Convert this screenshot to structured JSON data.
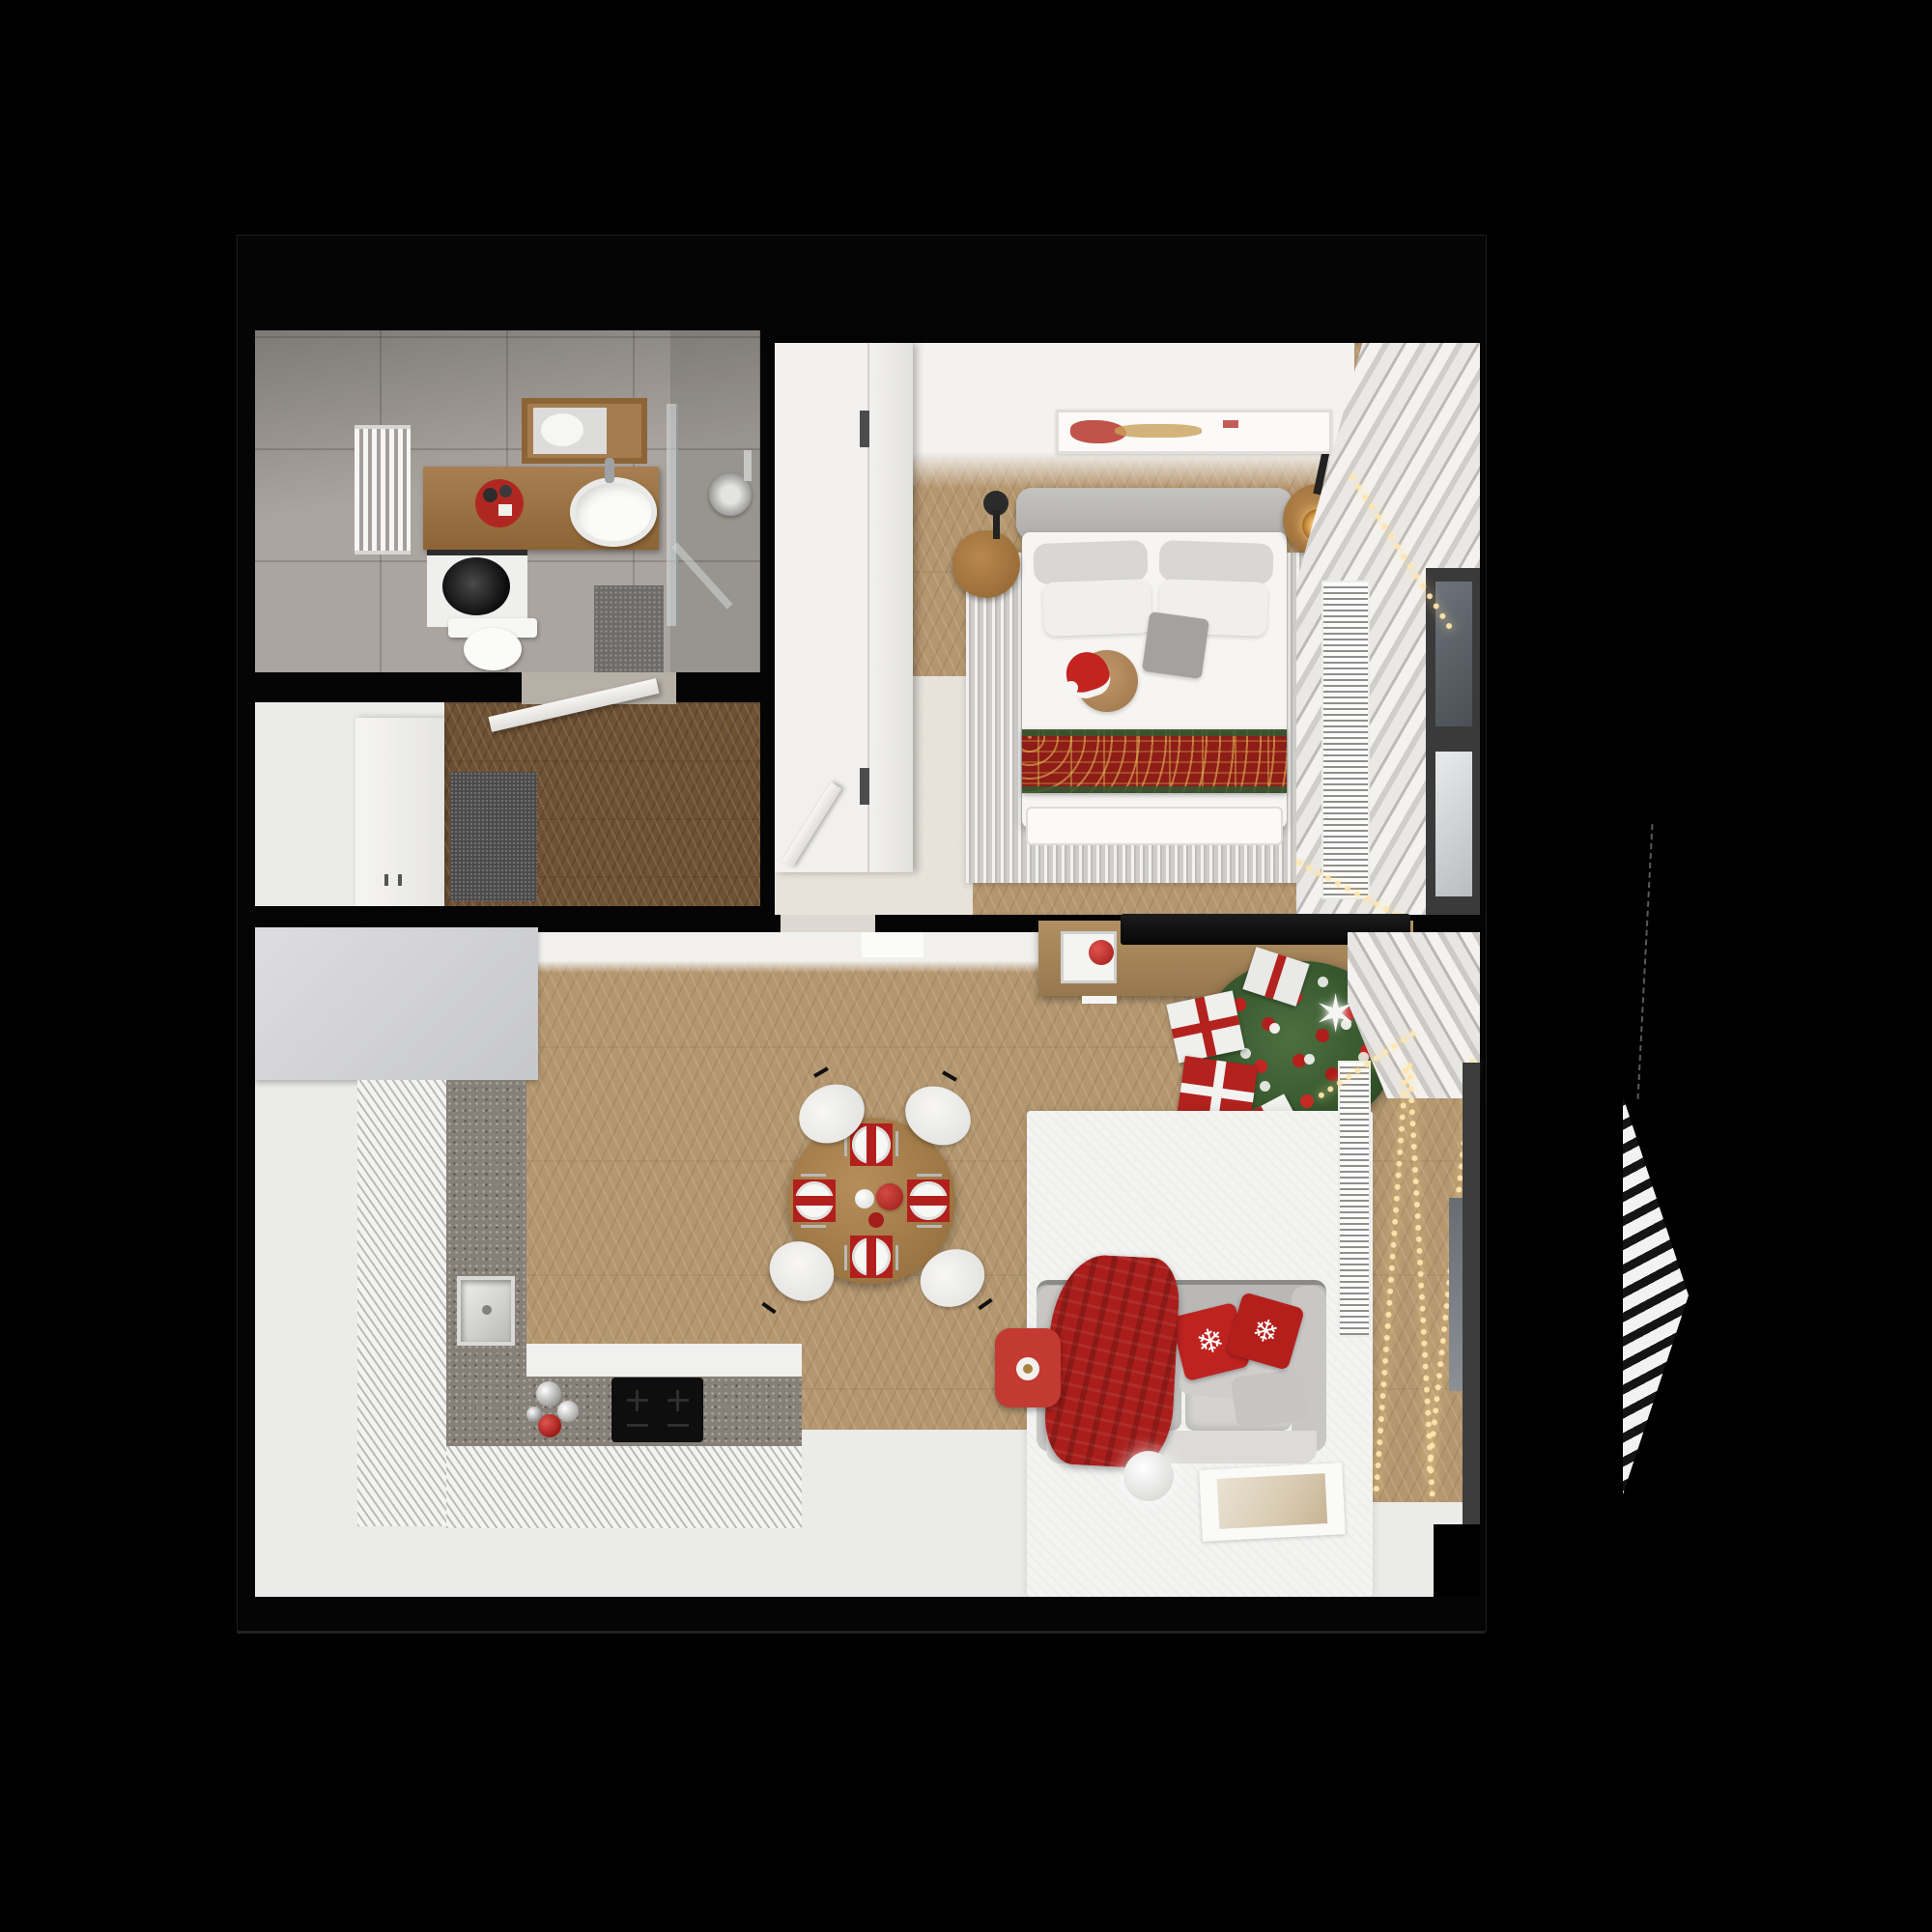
{
  "meta": {
    "title": "Top-down 3D render of a small apartment floor plan decorated for Christmas",
    "view": "orthographic top view",
    "background": "black"
  },
  "palette": {
    "wall": "#050505",
    "wood": "#b5976f",
    "wood_dark": "#6f5133",
    "tile": "#aaa59f",
    "floor_white": "#ebebe9",
    "counter": "#878078",
    "sofa_gray": "#cecdcb",
    "christmas_red": "#b3221e",
    "throw_red": "#a91e1b",
    "gold": "#caa84c",
    "tree_green": "#3c5a31",
    "light": "#ffe6ae"
  },
  "rooms": {
    "bathroom": {
      "name": "Bathroom",
      "floor": "gray stone tiles",
      "items": [
        "towel radiator",
        "wooden vanity",
        "red tray with toiletries",
        "wall shelf with mirror",
        "oval countertop sink",
        "washing machine",
        "toilet",
        "glass shower screen",
        "shower head",
        "gray bath mat"
      ]
    },
    "hallway": {
      "name": "Hallway",
      "floor": "dark herringbone wood + white area",
      "items": [
        "white wardrobe",
        "dark doormat",
        "open white door"
      ]
    },
    "bedroom": {
      "name": "Bedroom",
      "floor": "light chevron wood",
      "items": [
        "white wardrobe",
        "double bed with gray headboard",
        "white pillows",
        "gray tote bag",
        "teddy bear with santa hat",
        "red and gold christmas bed runner",
        "striped gray rug",
        "round wooden nightstand left",
        "round wooden nightstand right with lit candle",
        "black ceiling lamps",
        "abstract wall art",
        "white curtains",
        "string lights garland",
        "floor radiator grille",
        "corner window"
      ]
    },
    "living_kitchen": {
      "name": "Living room with kitchen",
      "floor": "light chevron wood + white floor + white rug",
      "items": [
        "gray tall kitchen units",
        "L-shaped kitchen counter",
        "square steel sink",
        "black induction cooktop",
        "silver and red baubles on counter",
        "round wooden dining table",
        "four white chairs",
        "four red place settings with striped plates",
        "red teapot",
        "wooden TV sideboard",
        "open drawer with red bauble",
        "flat TV lying on sideboard",
        "christmas tree with red baubles and white star",
        "gift boxes",
        "white area rug",
        "gray two-seat sofa",
        "red plaid throw",
        "red snowflake cushions",
        "gray cushions",
        "red side table with cup",
        "white floor ball lamp",
        "poster lying on rug",
        "white curtains",
        "floor radiator grille",
        "string light strands",
        "window with dark frame"
      ]
    },
    "exterior": {
      "name": "Outside structure",
      "items": [
        "striped louver shade",
        "thin dashed guy line"
      ]
    }
  }
}
